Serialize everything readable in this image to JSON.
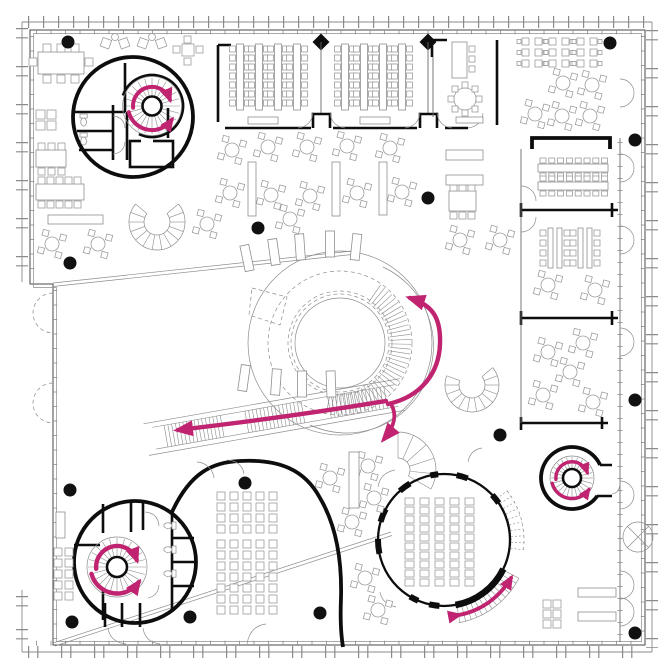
{
  "meta": {
    "description": "Architectural floor plan: open library floor with central circular ramp, three spiral stair cores, round auditorium, classrooms and scattered furniture; magenta arrows mark circulation.",
    "floor_label": "floor plan"
  },
  "colors": {
    "accent": "#c02471",
    "wall": "#0d0d0d",
    "furniture": "#9c9c9c",
    "background": "#ffffff"
  },
  "plan": {
    "columns": [
      [
        68,
        42
      ],
      [
        610,
        43
      ],
      [
        635,
        140
      ],
      [
        70,
        263
      ],
      [
        258,
        228
      ],
      [
        428,
        198
      ],
      [
        70,
        490
      ],
      [
        245,
        483
      ],
      [
        635,
        400
      ],
      [
        500,
        435
      ],
      [
        190,
        617
      ],
      [
        72,
        622
      ],
      [
        320,
        613
      ],
      [
        635,
        633
      ]
    ],
    "round_tables": [
      [
        232,
        150
      ],
      [
        268,
        147
      ],
      [
        307,
        147
      ],
      [
        347,
        146
      ],
      [
        390,
        148
      ],
      [
        230,
        193
      ],
      [
        271,
        195
      ],
      [
        310,
        196
      ],
      [
        357,
        193
      ],
      [
        402,
        192
      ],
      [
        207,
        224
      ],
      [
        290,
        219
      ],
      [
        52,
        244
      ],
      [
        98,
        244
      ],
      [
        460,
        240
      ],
      [
        500,
        240
      ],
      [
        535,
        114
      ],
      [
        562,
        116
      ],
      [
        590,
        116
      ],
      [
        563,
        83
      ],
      [
        592,
        85
      ],
      [
        548,
        285
      ],
      [
        595,
        290
      ],
      [
        548,
        352
      ],
      [
        583,
        343
      ],
      [
        570,
        372
      ],
      [
        543,
        395
      ],
      [
        593,
        402
      ],
      [
        330,
        478
      ],
      [
        352,
        522
      ],
      [
        374,
        498
      ],
      [
        368,
        466
      ],
      [
        365,
        578
      ],
      [
        378,
        610
      ]
    ],
    "desk_rows": {
      "y": 44,
      "xs": [
        240,
        259,
        278,
        297,
        345,
        364,
        383,
        402
      ]
    },
    "seat_grids": [
      {
        "x": 217,
        "y": 492,
        "cols": 5,
        "rows": 4,
        "dx": 13,
        "dy": 11,
        "w": 8,
        "h": 8
      },
      {
        "x": 217,
        "y": 540,
        "cols": 5,
        "rows": 7,
        "dx": 13,
        "dy": 11,
        "w": 8,
        "h": 8
      },
      {
        "x": 405,
        "y": 498,
        "cols": 5,
        "rows": 10,
        "dx": 15,
        "dy": 9,
        "w": 9,
        "h": 7
      },
      {
        "x": 54,
        "y": 548,
        "cols": 2,
        "rows": 5,
        "dx": 11,
        "dy": 11,
        "w": 8,
        "h": 8
      },
      {
        "x": 543,
        "y": 600,
        "cols": 2,
        "rows": 3,
        "dx": 10,
        "dy": 10,
        "w": 8,
        "h": 8
      }
    ],
    "table_groups": [
      {
        "x": 522,
        "y": 38
      },
      {
        "x": 549,
        "y": 38
      },
      {
        "x": 577,
        "y": 38
      }
    ],
    "bench_rows": [
      {
        "x": 538,
        "y": 158
      },
      {
        "x": 538,
        "y": 176
      }
    ],
    "vtable_groups": [
      {
        "x": 548,
        "y": 228
      },
      {
        "x": 578,
        "y": 228
      }
    ],
    "shelves": [
      [
        248,
        162,
        8,
        54
      ],
      [
        332,
        162,
        8,
        54
      ],
      [
        379,
        162,
        8,
        53
      ],
      [
        349,
        452,
        10,
        56
      ],
      [
        446,
        150,
        37,
        10
      ],
      [
        446,
        175,
        37,
        10
      ],
      [
        48,
        215,
        55,
        9
      ],
      [
        578,
        588,
        38,
        9
      ],
      [
        578,
        612,
        38,
        9
      ],
      [
        56,
        512,
        9,
        26
      ]
    ],
    "radial_shelves": [
      [
        247,
        258,
        -12
      ],
      [
        274,
        252,
        -8
      ],
      [
        300,
        247,
        -4
      ],
      [
        330,
        244,
        0
      ],
      [
        356,
        247,
        6
      ],
      [
        244,
        378,
        8
      ],
      [
        276,
        382,
        4
      ],
      [
        302,
        384,
        0
      ],
      [
        331,
        384,
        -2
      ]
    ],
    "radial_stairs": [
      {
        "name": "central-ramp-treads",
        "cx": 340,
        "cy": 343,
        "r1": 50,
        "r2": 71,
        "a1": -55,
        "a2": 103,
        "step": 4,
        "band": false
      },
      {
        "name": "auditorium-outer-stair",
        "cx": 444,
        "cy": 540,
        "r1": 68,
        "r2": 84,
        "a1": 27,
        "a2": 80,
        "step": 4,
        "band": true
      },
      {
        "name": "auditorium-dashed-stair",
        "cx": 444,
        "cy": 540,
        "r1": 67,
        "r2": 80,
        "a1": -38,
        "a2": 8,
        "step": 5,
        "band": true,
        "dashed": true
      },
      {
        "name": "spiral-stair-top-left",
        "cx": 152,
        "cy": 106,
        "r1": 10,
        "r2": 28,
        "a1": 0,
        "a2": 345,
        "step": 15,
        "band": false
      },
      {
        "name": "spiral-stair-bottom-left",
        "cx": 117,
        "cy": 567,
        "r1": 11,
        "r2": 29,
        "a1": 0,
        "a2": 345,
        "step": 15,
        "band": false
      },
      {
        "name": "spiral-stair-bottom-right",
        "cx": 572,
        "cy": 478,
        "r1": 10,
        "r2": 21,
        "a1": 0,
        "a2": 345,
        "step": 15,
        "band": false
      },
      {
        "name": "fan-stair",
        "cx": 398,
        "cy": 470,
        "r1": 12,
        "r2": 38,
        "a1": -90,
        "a2": 30,
        "step": 24,
        "band": true
      },
      {
        "name": "curved-bench-right",
        "cx": 472,
        "cy": 385,
        "r1": 13,
        "r2": 27,
        "a1": -40,
        "a2": 200,
        "step": 20,
        "band": true
      },
      {
        "name": "curved-bench-left",
        "cx": 157,
        "cy": 222,
        "r1": 13,
        "r2": 28,
        "a1": -40,
        "a2": 220,
        "step": 20,
        "band": true
      }
    ],
    "wall_arcs": [
      {
        "cx": 444,
        "cy": 540,
        "r": 66,
        "a1": 26,
        "a2": 80,
        "w": 6.5
      },
      {
        "cx": 444,
        "cy": 540,
        "r": 66,
        "a1": 94,
        "a2": 103,
        "w": 6
      },
      {
        "cx": 444,
        "cy": 540,
        "r": 66,
        "a1": 113,
        "a2": 121,
        "w": 6
      },
      {
        "cx": 444,
        "cy": 540,
        "r": 66,
        "a1": 168,
        "a2": 181,
        "w": 6
      },
      {
        "cx": 444,
        "cy": 540,
        "r": 66,
        "a1": 196,
        "a2": 208,
        "w": 6
      },
      {
        "cx": 444,
        "cy": 540,
        "r": 66,
        "a1": 228,
        "a2": 239,
        "w": 6
      },
      {
        "cx": 444,
        "cy": 540,
        "r": 66,
        "a1": 258,
        "a2": 265,
        "w": 6
      },
      {
        "cx": 444,
        "cy": 540,
        "r": 66,
        "a1": 281,
        "a2": 291,
        "w": 6
      },
      {
        "cx": 444,
        "cy": 540,
        "r": 66,
        "a1": 317,
        "a2": 326,
        "w": 6
      }
    ],
    "long_stair": {
      "x": 162,
      "y": 448,
      "angle": -10,
      "len": 232,
      "h": 22,
      "groups": [
        [
          6,
          64
        ],
        [
          88,
          148
        ],
        [
          172,
          230
        ]
      ]
    },
    "double_doors": {
      "x": 620,
      "ys": [
        93,
        168,
        240,
        342,
        495,
        585,
        612
      ]
    }
  }
}
